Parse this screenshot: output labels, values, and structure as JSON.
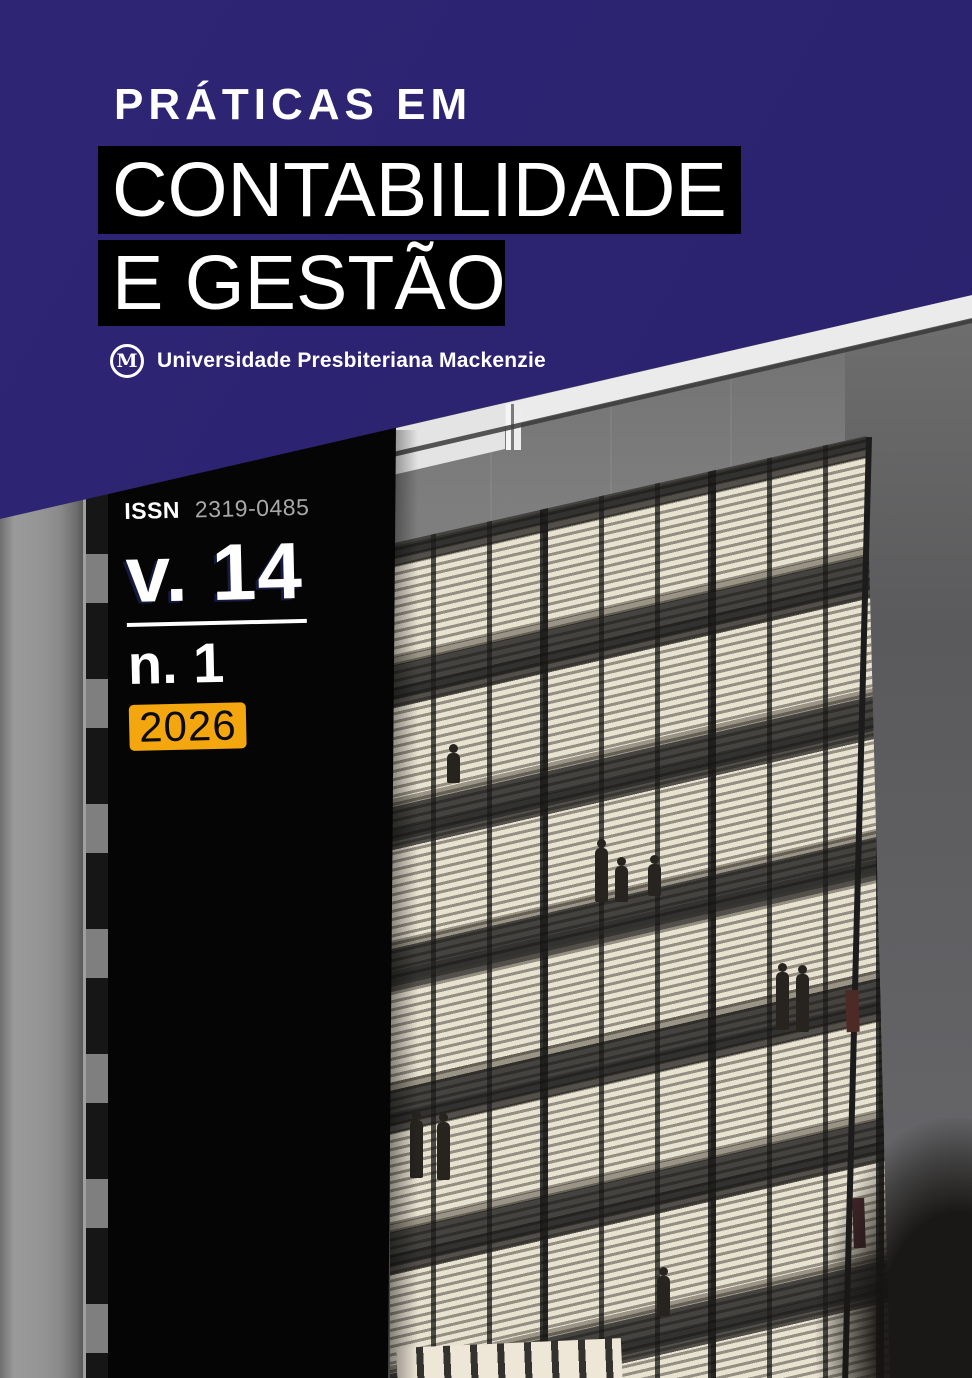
{
  "journal": {
    "pretitle": "PRÁTICAS EM",
    "title_line1": "CONTABILIDADE",
    "title_line2": "E GESTÃO"
  },
  "publisher": {
    "logo_letter": "M",
    "name": "Universidade Presbiteriana Mackenzie"
  },
  "issue": {
    "issn_label": "ISSN",
    "issn_number": "2319-0485",
    "volume": "v. 14",
    "number": "n. 1",
    "year": "2026"
  },
  "colors": {
    "banner_blue": "#2B236F",
    "title_box_black": "#000000",
    "panel_black": "#050505",
    "year_badge_orange": "#F3A60D",
    "issn_number_gray": "#A8A8A8"
  },
  "photo": {
    "alt": "Night photograph of a modern concrete university building with a horizontally louvered glass facade, illuminated floors and small human silhouettes"
  }
}
